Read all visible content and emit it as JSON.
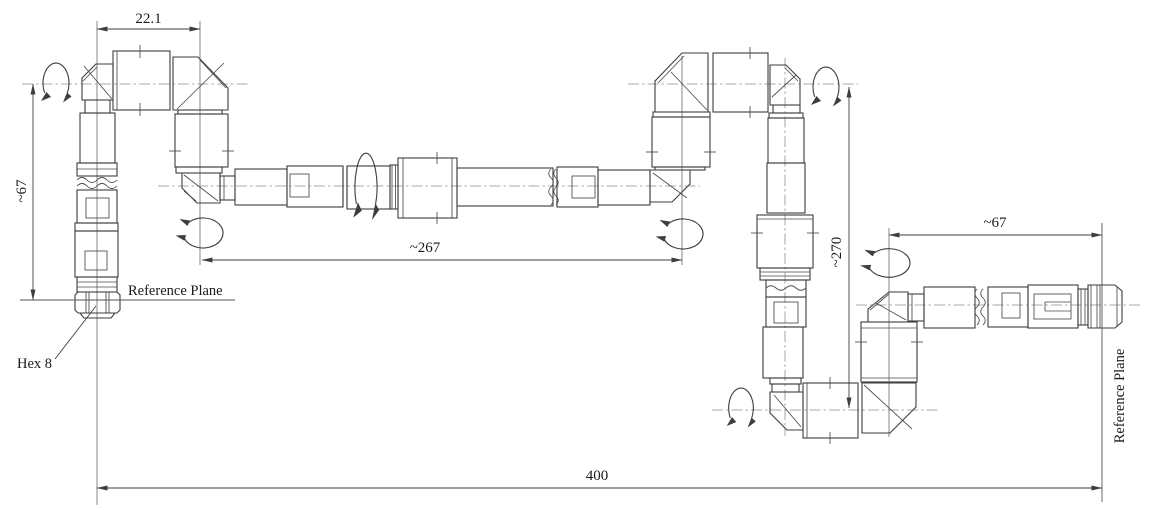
{
  "drawing": {
    "type": "technical-drawing-cable-assembly",
    "dimensions": {
      "top_width": "22.1",
      "left_height": "~67",
      "middle_length": "~267",
      "right_height": "~270",
      "right_length": "~67",
      "overall_length": "400"
    },
    "labels": {
      "reference_plane_left": "Reference Plane",
      "reference_plane_right": "Reference Plane",
      "hex": "Hex 8"
    },
    "colors": {
      "line": "#3d3d42",
      "centerline": "#8f8f94",
      "background": "#ffffff"
    }
  }
}
